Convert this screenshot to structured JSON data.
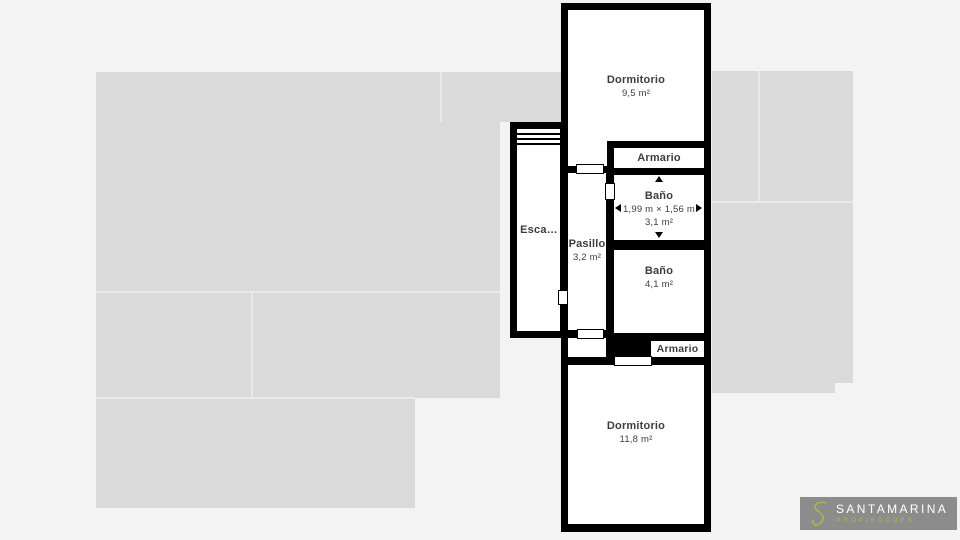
{
  "colors": {
    "page_bg": "#f3f3f3",
    "silhouette": "#dadada",
    "wall": "#000000",
    "room_fill": "#ffffff",
    "label_text": "#3d3d3d",
    "logo_box": "#8c8c8c",
    "logo_accent": "#b6b63e",
    "logo_brand_text": "#ffffff"
  },
  "plan": {
    "rooms": [
      {
        "name": "Dormitorio",
        "area": "9,5 m²"
      },
      {
        "name": "Armario"
      },
      {
        "name": "Baño",
        "dimensions": "1,99 m × 1,56 m",
        "area": "3,1 m²"
      },
      {
        "name": "Baño",
        "area": "4,1 m²"
      },
      {
        "name": "Armario"
      },
      {
        "name": "Pasillo",
        "area": "3,2 m²"
      },
      {
        "name": "Esca…"
      },
      {
        "name": "Dormitorio",
        "area": "11,8 m²"
      }
    ]
  },
  "logo": {
    "brand": "SANTAMARINA",
    "tagline": "PROPIEDADES"
  }
}
